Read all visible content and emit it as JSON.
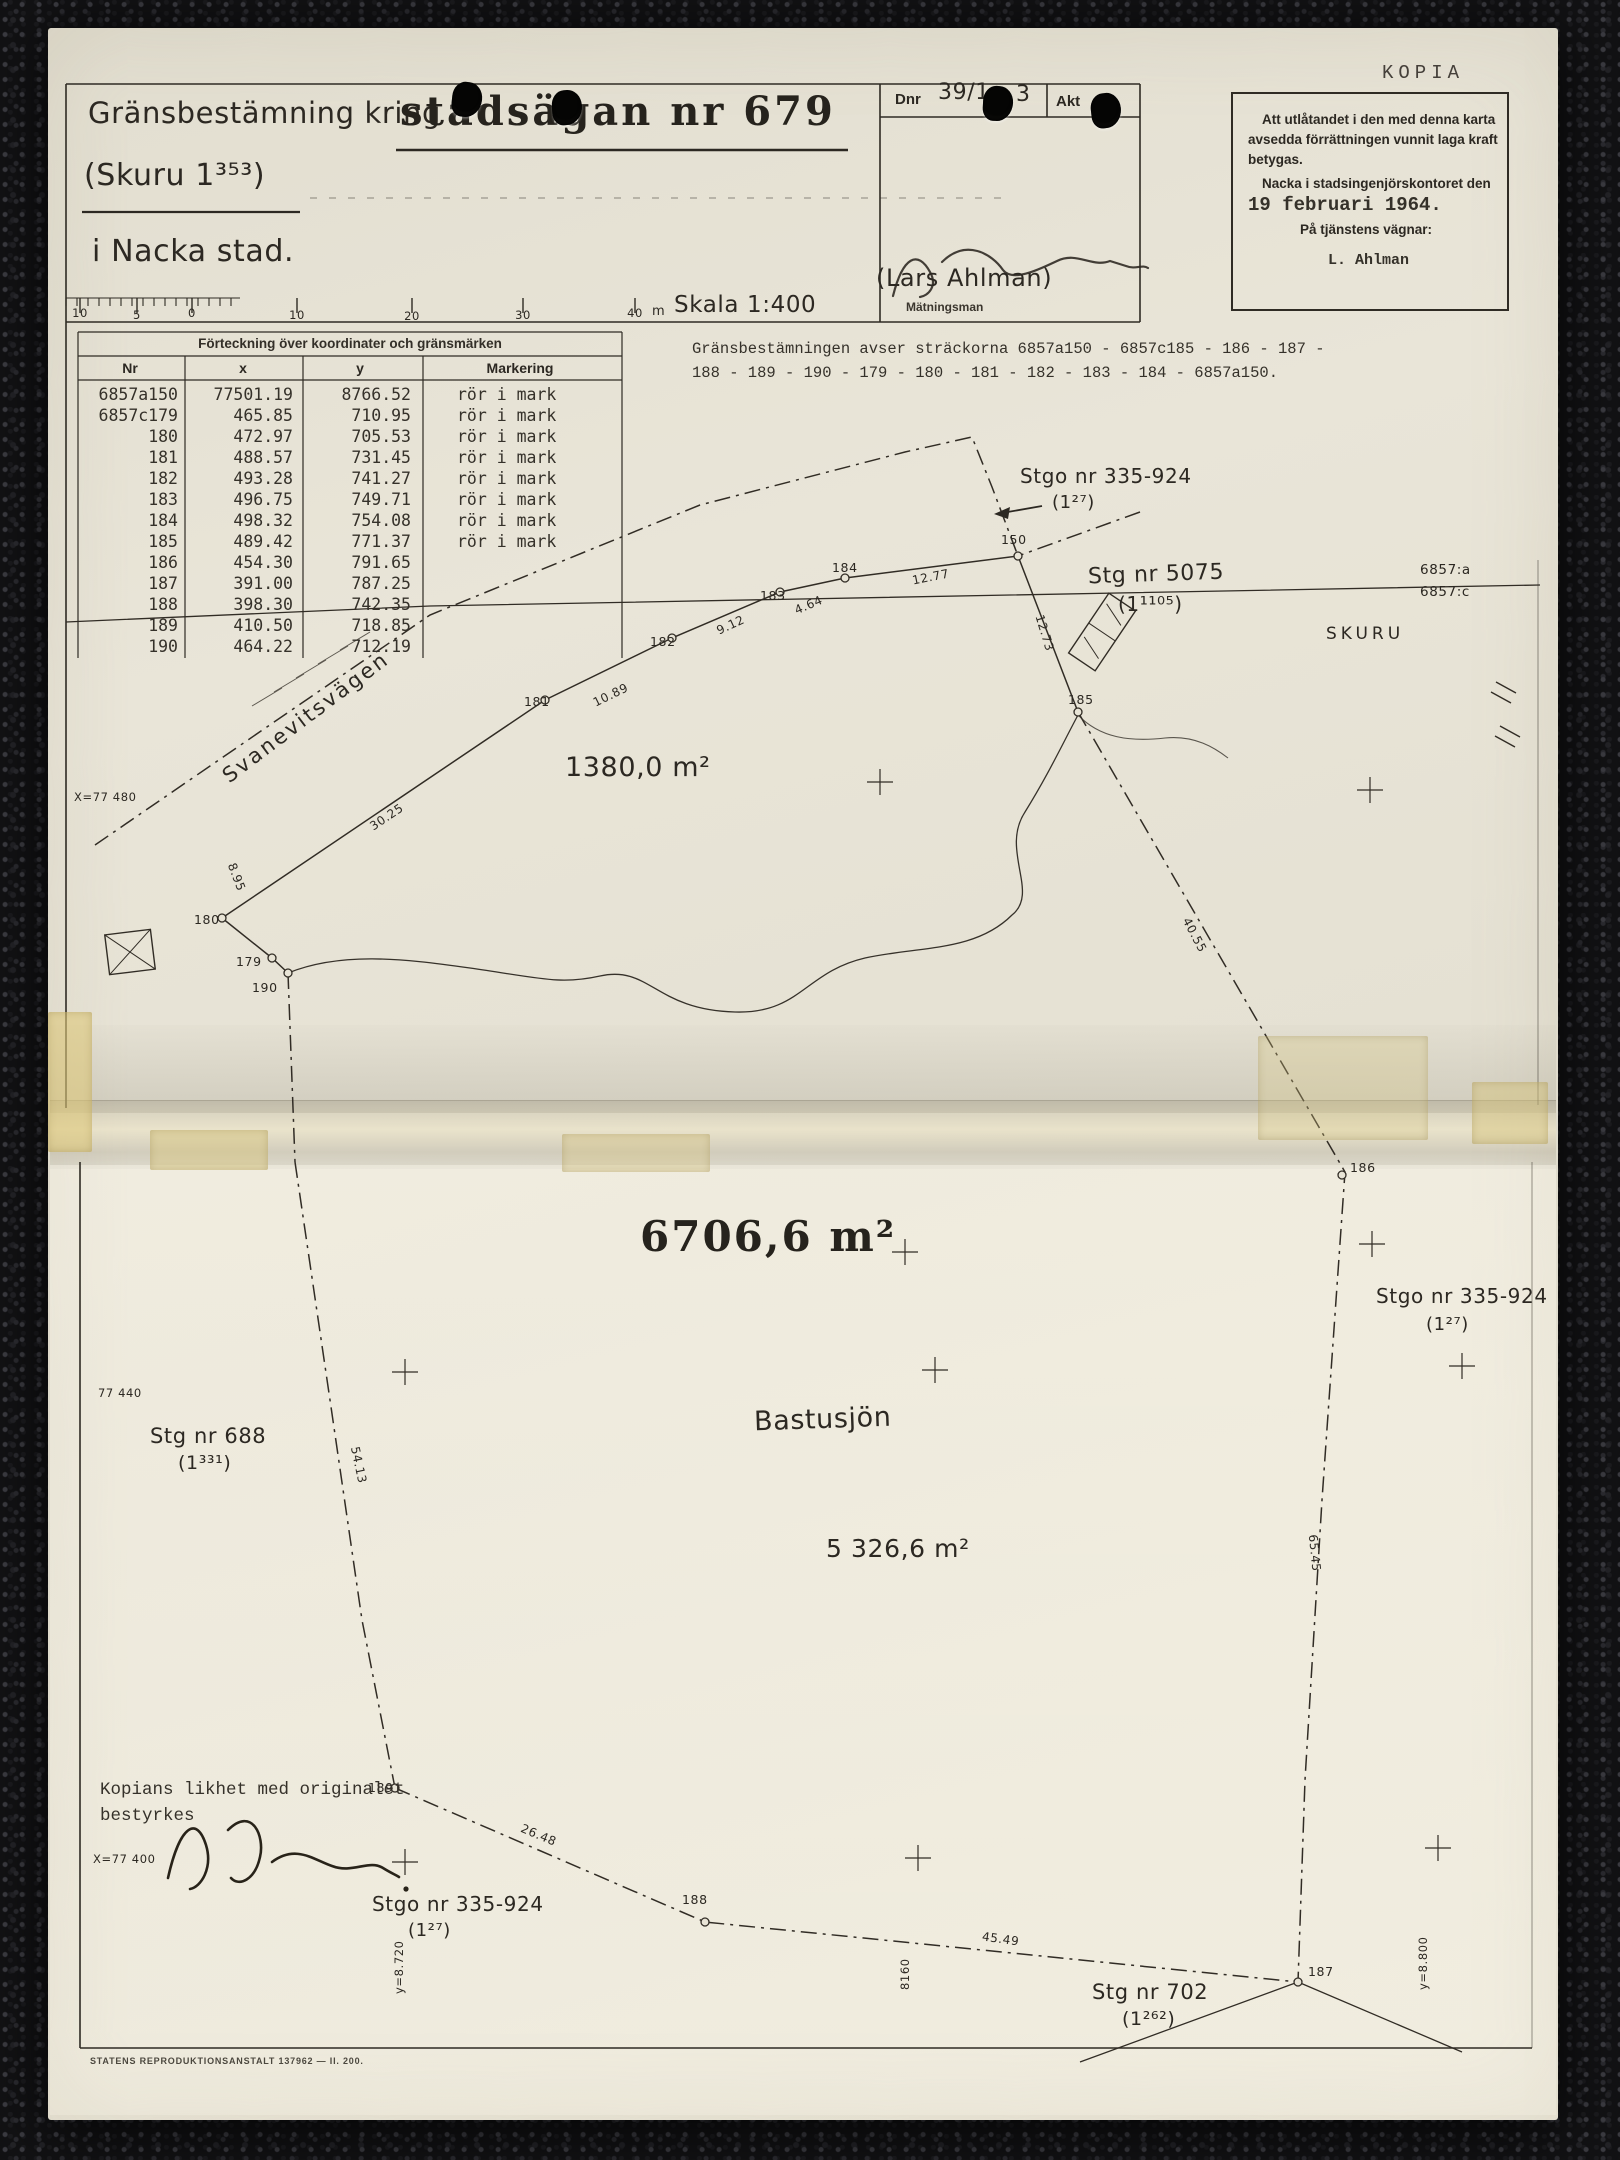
{
  "header": {
    "title_line1_normal": "Gränsbestämning kring",
    "title_line1_stamped": "stadsägan nr 679",
    "title_line2": "(Skuru 1³⁵³)",
    "title_line3": "i Nacka stad.",
    "dnr_label": "Dnr",
    "dnr_value_visible": "39/1",
    "dnr_value_tail": "3",
    "akt_label": "Akt",
    "signature_name": "(Lars Ahlman)",
    "signature_role": "Mätningsman",
    "kopia": "KOPIA",
    "lagakraft": {
      "line1": "Att utlåtandet i den med denna karta",
      "line2": "avsedda förrättningen vunnit laga kraft",
      "line3": "betygas.",
      "line4": "Nacka i stadsingenjörskontoret den",
      "date": "19 februari 1964.",
      "line5": "På tjänstens vägnar:",
      "name": "L. Ahlman"
    }
  },
  "scalebar": {
    "labels": [
      "10",
      "5",
      "0",
      "10",
      "20",
      "30",
      "40"
    ],
    "unit": "m",
    "scale_text": "Skala 1:400"
  },
  "table": {
    "title": "Förteckning över koordinater och gränsmärken",
    "headers": [
      "Nr",
      "x",
      "y",
      "Markering"
    ],
    "rows": [
      {
        "nr": "6857a150",
        "x": "77501.19",
        "y": "8766.52",
        "mark": "rör i mark"
      },
      {
        "nr": "6857c179",
        "x": "465.85",
        "y": "710.95",
        "mark": "rör i mark"
      },
      {
        "nr": "180",
        "x": "472.97",
        "y": "705.53",
        "mark": "rör i mark"
      },
      {
        "nr": "181",
        "x": "488.57",
        "y": "731.45",
        "mark": "rör i mark"
      },
      {
        "nr": "182",
        "x": "493.28",
        "y": "741.27",
        "mark": "rör i mark"
      },
      {
        "nr": "183",
        "x": "496.75",
        "y": "749.71",
        "mark": "rör i mark"
      },
      {
        "nr": "184",
        "x": "498.32",
        "y": "754.08",
        "mark": "rör i mark"
      },
      {
        "nr": "185",
        "x": "489.42",
        "y": "771.37",
        "mark": "rör i mark"
      },
      {
        "nr": "186",
        "x": "454.30",
        "y": "791.65",
        "mark": ""
      },
      {
        "nr": "187",
        "x": "391.00",
        "y": "787.25",
        "mark": ""
      },
      {
        "nr": "188",
        "x": "398.30",
        "y": "742.35",
        "mark": ""
      },
      {
        "nr": "189",
        "x": "410.50",
        "y": "718.85",
        "mark": ""
      },
      {
        "nr": "190",
        "x": "464.22",
        "y": "712.19",
        "mark": ""
      }
    ]
  },
  "note": {
    "line1": "Gränsbestämningen avser sträckorna 6857a150 - 6857c185 - 186 - 187 -",
    "line2": "188 - 189 - 190 - 179 - 180 - 181 - 182 - 183 - 184 - 6857a150."
  },
  "map_top": {
    "stgo335": "Stgo nr 335-924",
    "stgo335_sub": "(1²⁷)",
    "pt150": "150",
    "stg5075": "Stg nr 5075",
    "stg5075_sub": "(1¹¹⁰⁵)",
    "skuru": "SKURU",
    "b6857a": "6857:a",
    "b6857c": "6857:c",
    "road": "Svanevitsvägen",
    "area": "1380,0 m²",
    "x_grid": "X=77 480",
    "m3025": "30.25",
    "m1089": "10.89",
    "m912": "9.12",
    "m464": "4.64",
    "m1277": "12.77",
    "m1273": "12.73",
    "m4055": "40.55",
    "m895": "8.95",
    "pt179": "179",
    "pt180": "180",
    "pt181": "181",
    "pt182": "182",
    "pt183": "183",
    "pt184": "184",
    "pt185": "185",
    "pt186": "186",
    "pt190": "190"
  },
  "map_bottom": {
    "area_total": "6706,6 m²",
    "stgo335_right": "Stgo nr 335-924",
    "stgo335_right_sub": "(1²⁷)",
    "x_grid_440": "77 440",
    "stg688": "Stg nr 688",
    "stg688_sub": "(1³³¹)",
    "lake_name": "Bastusjön",
    "area_lake": "5 326,6 m²",
    "m5413": "54.13",
    "m6545": "65.45",
    "m2648": "26.48",
    "m4549": "45.49",
    "pt187": "187",
    "pt188": "188",
    "pt189": "189",
    "stgo335_bottom": "Stgo nr 335-924",
    "stgo335_bottom_sub": "(1²⁷)",
    "stg702": "Stg nr 702",
    "stg702_sub": "(1²⁶²)",
    "y_grid_8160": "8160",
    "y_grid_8720": "y=8.720",
    "y_grid_8800": "y=8.800",
    "certify_line1": "Kopians likhet med originalet",
    "certify_line2": "bestyrkes",
    "x_grid_400": "X=77 400",
    "footer": "STATENS REPRODUKTIONSANSTALT 137962 — II. 200."
  }
}
